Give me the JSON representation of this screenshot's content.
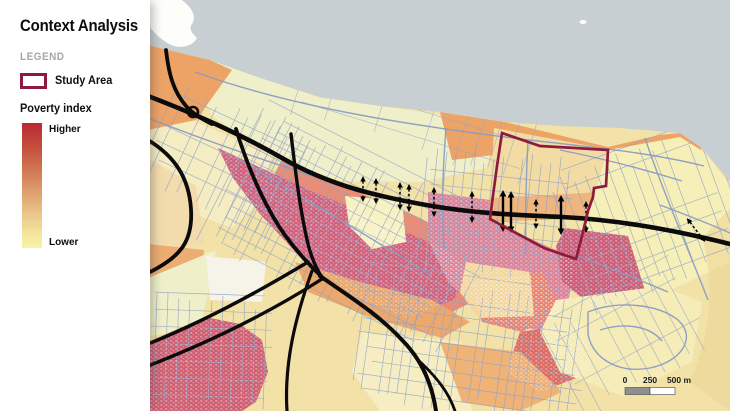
{
  "panel": {
    "title": "Context Analysis",
    "legend_heading": "LEGEND",
    "study_area_label": "Study Area",
    "poverty_heading": "Poverty index",
    "higher_label": "Higher",
    "lower_label": "Lower"
  },
  "map": {
    "scale_bar": {
      "t0": "0",
      "t250": "250",
      "t500": "500 m"
    }
  },
  "colors": {
    "study_area_outline": "#8e1b3e",
    "poverty_high": "#b92a31",
    "poverty_low": "#f9f4a5",
    "sea": "#c7cfd2",
    "land_base": "#f2e2a8",
    "major_roads": "#0b0b0b",
    "streets": "#94a3c6",
    "legend_muted_text": "#a6a6a6",
    "scalebar_fill": "#8f8f8f"
  },
  "icons": {
    "study_area_swatch": "rectangle-outline",
    "poverty_gradient": "vertical-gradient-bar",
    "flow_arrows": "double-headed-arrow",
    "scale_bar": "map-scale-bar"
  }
}
